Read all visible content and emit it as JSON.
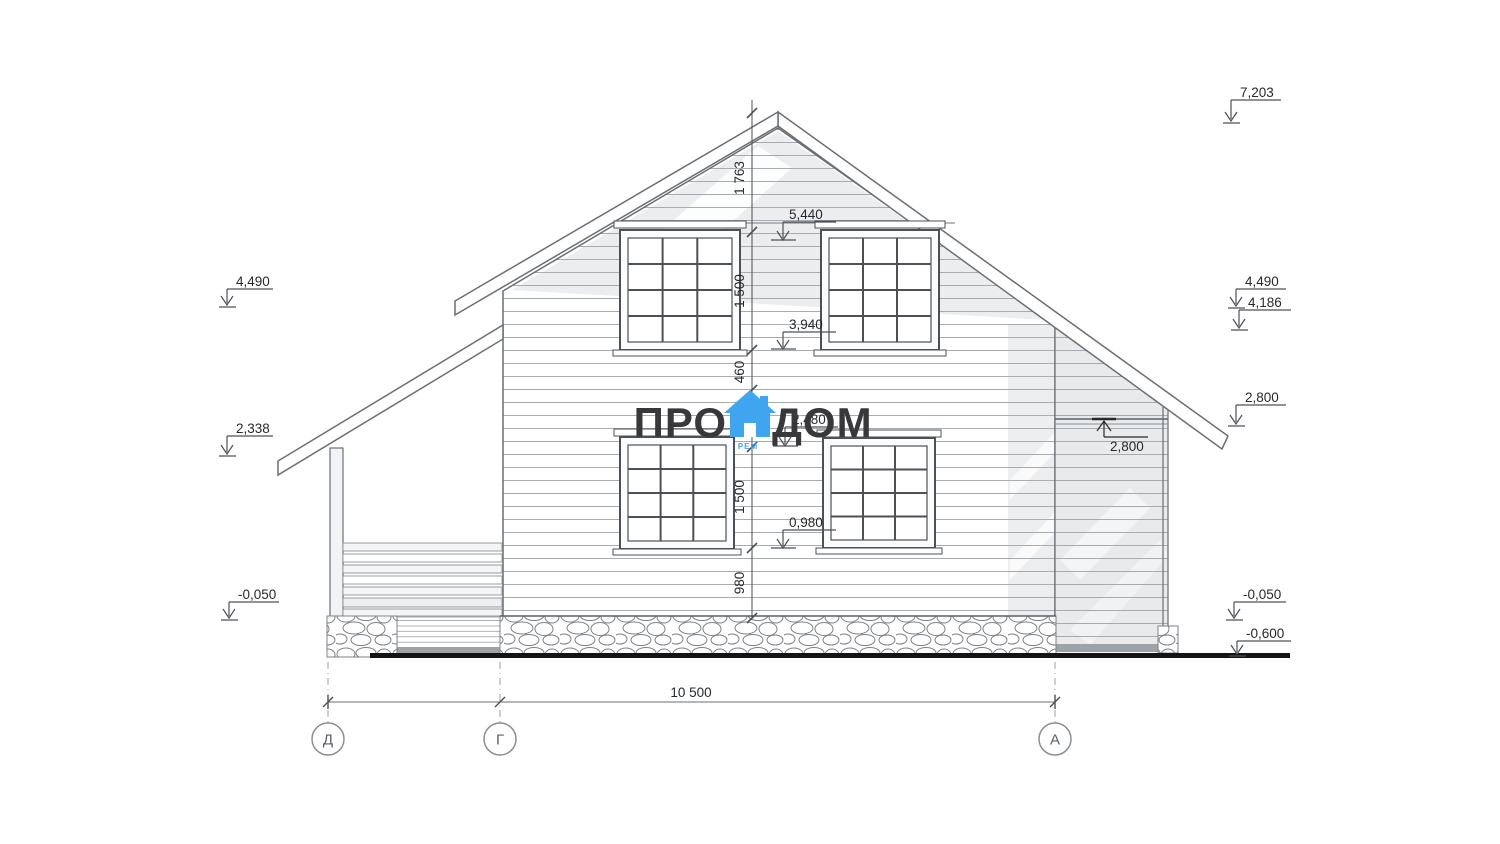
{
  "logo": {
    "word1": "ПРО",
    "word2": "ДОМ",
    "subtext": "РЕМ"
  },
  "chain": {
    "segments": [
      "1 763",
      "1 500",
      "460",
      "1 500",
      "980"
    ],
    "levels": [
      "5,440",
      "3,940",
      "2,480",
      "0,980"
    ]
  },
  "left_levels": [
    "4,490",
    "2,338",
    "-0,050"
  ],
  "right_levels": [
    "7,203",
    "4,490",
    "4,186",
    "2,800",
    "-0,050",
    "-0,600"
  ],
  "wing_level": "2,800",
  "bottom": {
    "width": "10 500",
    "axes": [
      "Д",
      "Г",
      "А"
    ]
  },
  "colors": {
    "logo_blue": "#3fa5ee",
    "logo_dark": "#38383a",
    "line": "#5b6066",
    "ground": "#141414"
  }
}
